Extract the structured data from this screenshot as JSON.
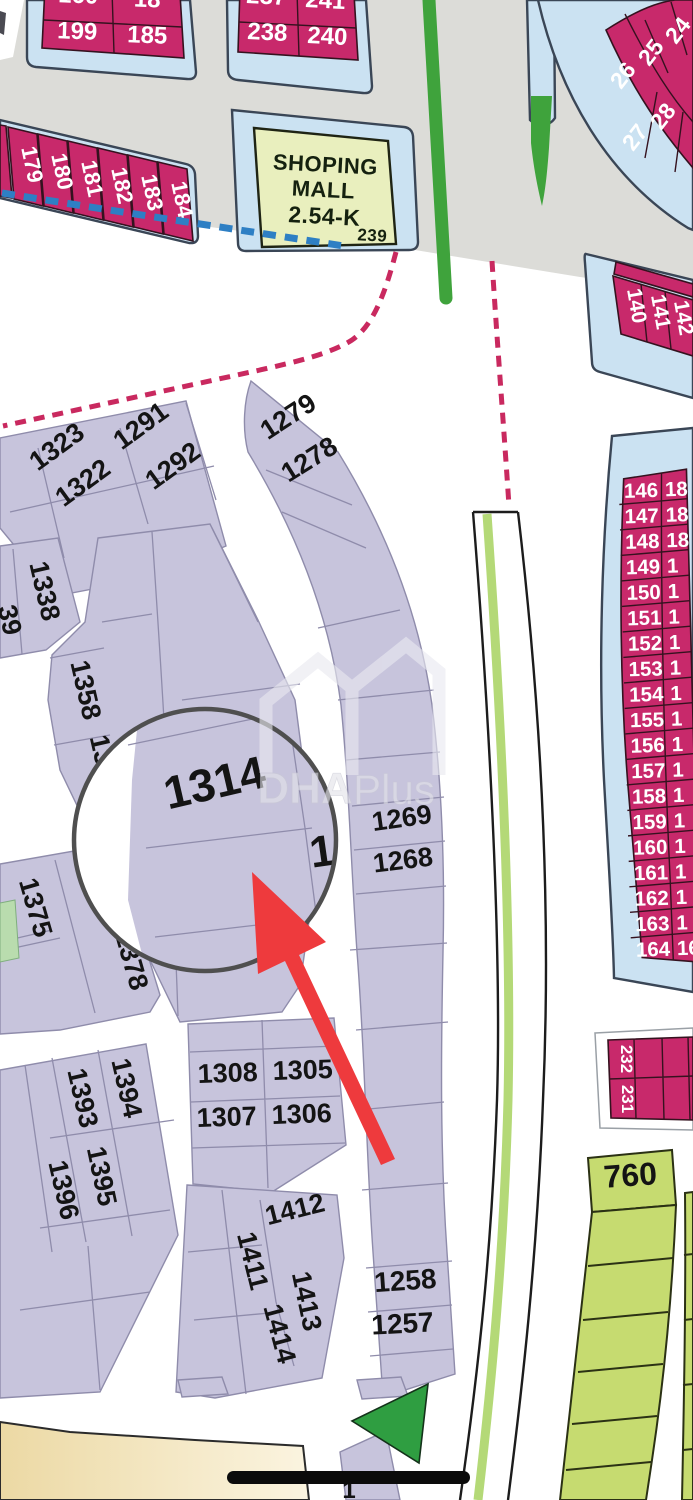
{
  "watermark": {
    "bold": "DHA",
    "light": "Plus"
  },
  "mall": {
    "line1": "SHOPING",
    "line2": "MALL",
    "line3": "2.54-K",
    "number": "239"
  },
  "magnifier": {
    "plot": "1314",
    "partial_right": "1"
  },
  "blocks": {
    "top_left": {
      "r1c1": "160",
      "r1c2": "18",
      "r2c1": "199",
      "r2c2": "185"
    },
    "top_mid": {
      "r1c1": "237",
      "r1c2": "241",
      "r2c1": "238",
      "r2c2": "240"
    },
    "left_strip": [
      "179",
      "180",
      "181",
      "182",
      "183",
      "184"
    ],
    "arc_upper": [
      "26",
      "25",
      "24"
    ],
    "arc_lower": [
      "27",
      "28"
    ],
    "col_140": [
      "140",
      "141",
      "142"
    ],
    "seq_left": [
      "146",
      "147",
      "148",
      "149",
      "150",
      "151",
      "152",
      "153",
      "154",
      "155",
      "156",
      "157",
      "158",
      "159",
      "160",
      "161",
      "162",
      "163",
      "164"
    ],
    "seq_right": [
      "18",
      "18",
      "18",
      "1",
      "1",
      "1",
      "1",
      "1",
      "1",
      "1",
      "1",
      "1",
      "1",
      "1",
      "1",
      "1",
      "1",
      "1",
      "16"
    ],
    "pair_230": [
      "232",
      "231"
    ],
    "plot_760": "760"
  },
  "lavender_plots": {
    "p1323": "1323",
    "p1322": "1322",
    "p1291": "1291",
    "p1292": "1292",
    "p1279": "1279",
    "p1278": "1278",
    "p1269": "1269",
    "p1268": "1268",
    "p1258": "1258",
    "p1257": "1257",
    "p1338": "1338",
    "frag_left": "39",
    "p1358": "1358",
    "frag_13": "13",
    "p1375": "1375",
    "p1378": "1378",
    "p1394": "1394",
    "p1393": "1393",
    "p1395": "1395",
    "p1396": "1396",
    "p1308": "1308",
    "p1305": "1305",
    "p1307": "1307",
    "p1306": "1306",
    "p1412": "1412",
    "p1411": "1411",
    "p1413": "1413",
    "p1414": "1414",
    "frag_bottom": "1"
  }
}
